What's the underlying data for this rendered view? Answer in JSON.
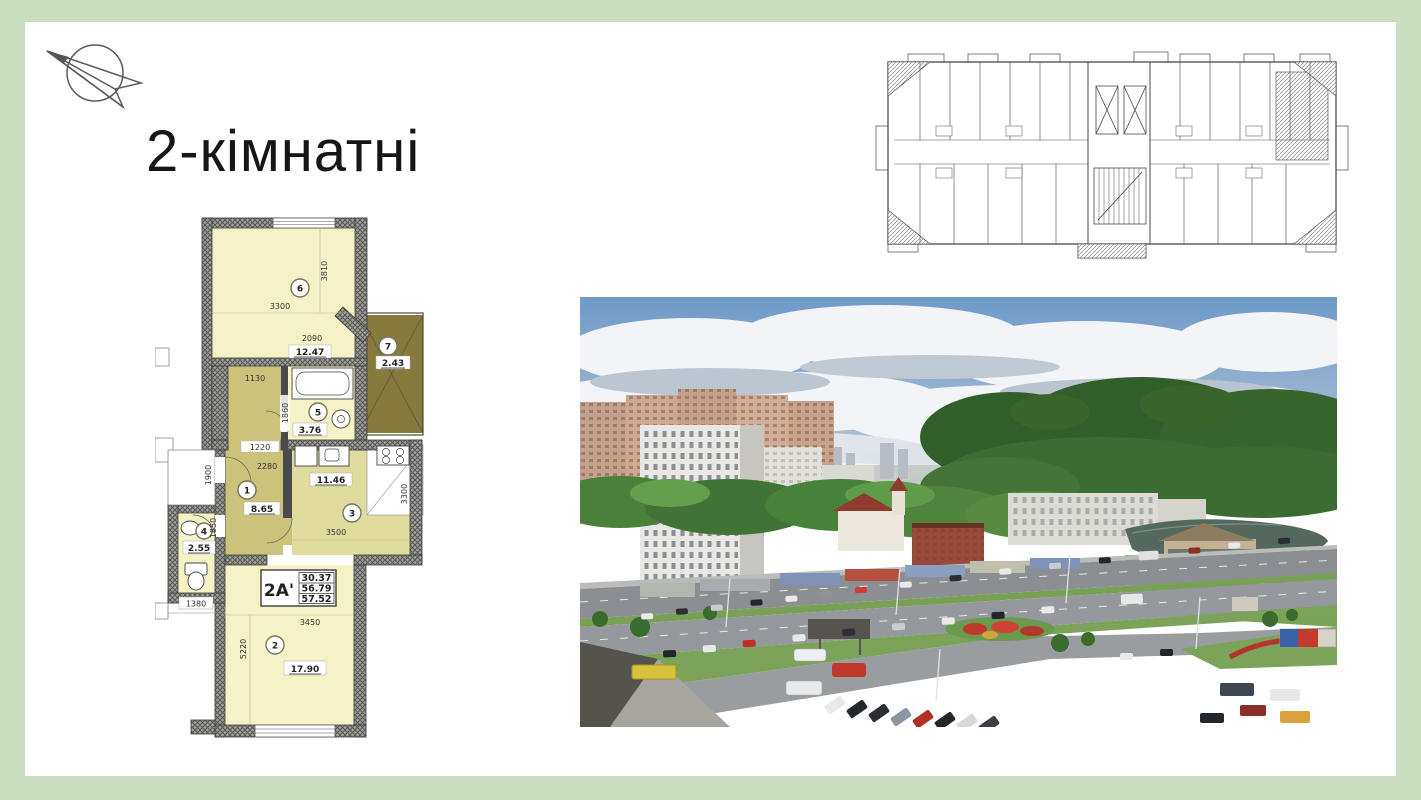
{
  "slide": {
    "title": "2-кімнатні"
  },
  "colors": {
    "background": "#cbdec2",
    "surface": "#ffffff",
    "plan_room_fill": "#f5f3c6",
    "plan_hall_fill": "#cbc27b",
    "plan_kitchen_fill": "#e0dc9d",
    "plan_balcony_fill": "#867b3c"
  },
  "apartment_plan": {
    "unit": {
      "code": "2A'",
      "area_line1": "30.37",
      "area_line2": "56.79",
      "area_line3": "57.52"
    },
    "rooms": {
      "r1": {
        "num": "1",
        "area": "8.65"
      },
      "r2": {
        "num": "2",
        "area": "17.90"
      },
      "r3": {
        "num": "3",
        "area": "11.46"
      },
      "r4": {
        "num": "4",
        "area": "2.55"
      },
      "r5": {
        "num": "5",
        "area": "3.76"
      },
      "r6": {
        "num": "6",
        "area": "12.47"
      },
      "r7": {
        "num": "7",
        "area": "2.43"
      }
    },
    "dimensions": {
      "d3810": "3810",
      "d3300_top": "3300",
      "d2090": "2090",
      "d1130": "1130",
      "d1860": "1860",
      "d1220": "1220",
      "d2280": "2280",
      "d1900": "1900",
      "d1850": "1850",
      "d1380": "1380",
      "d3500": "3500",
      "d3300_right": "3300",
      "d3450": "3450",
      "d5220": "5220"
    }
  }
}
